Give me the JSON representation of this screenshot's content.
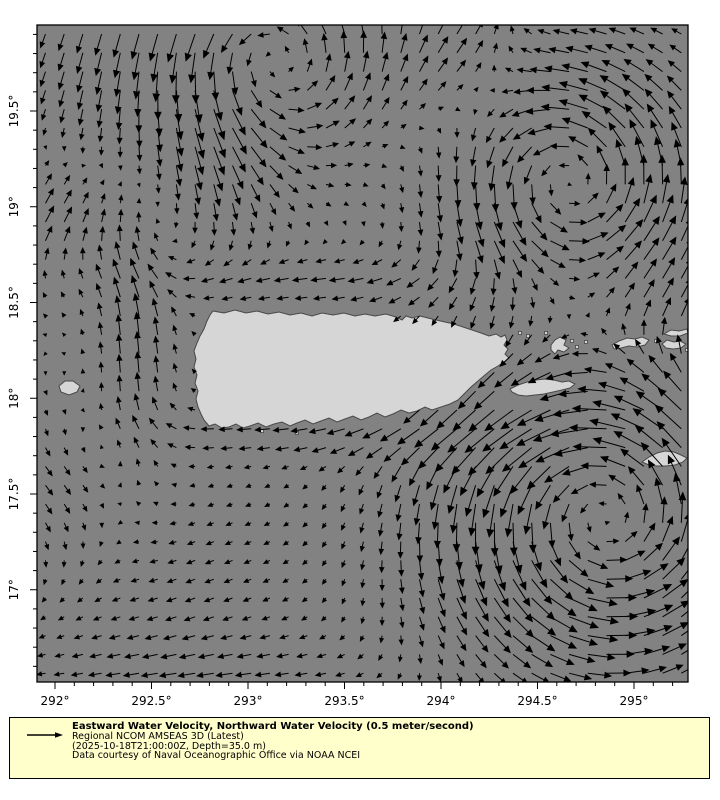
{
  "figure": {
    "width": 720,
    "height": 800,
    "background": "#ffffff"
  },
  "map": {
    "ocean_color": "#828282",
    "land_color": "#d6d6d6",
    "land_edge_color": "#484848",
    "arrow_color": "#000000",
    "frame_color": "#000000",
    "frame": {
      "left": 37,
      "top": 25,
      "right": 688,
      "bottom": 682
    },
    "projection": {
      "lon0": 292,
      "x0": 55,
      "px_per_deg_x": 193,
      "lat0": 19.5,
      "y0": 111,
      "px_per_deg_y": 191.5
    },
    "x_axis": {
      "ticks": [
        {
          "deg": 292.0,
          "label": "292°"
        },
        {
          "deg": 292.5,
          "label": "292.5°"
        },
        {
          "deg": 293.0,
          "label": "293°"
        },
        {
          "deg": 293.5,
          "label": "293.5°"
        },
        {
          "deg": 294.0,
          "label": "294°"
        },
        {
          "deg": 294.5,
          "label": "294.5°"
        },
        {
          "deg": 295.0,
          "label": "295°"
        }
      ],
      "minor_step_deg": 0.1
    },
    "y_axis": {
      "ticks": [
        {
          "deg": 19.5,
          "label": "19.5°"
        },
        {
          "deg": 19.0,
          "label": "19°"
        },
        {
          "deg": 18.5,
          "label": "18.5°"
        },
        {
          "deg": 18.0,
          "label": "18°"
        },
        {
          "deg": 17.5,
          "label": "17.5°"
        },
        {
          "deg": 17.0,
          "label": "17°"
        }
      ],
      "minor_step_deg": 0.1
    }
  },
  "islands": {
    "puerto-rico": [
      [
        213,
        311
      ],
      [
        224,
        313
      ],
      [
        235,
        310
      ],
      [
        246,
        313
      ],
      [
        257,
        311
      ],
      [
        268,
        314
      ],
      [
        279,
        312
      ],
      [
        290,
        315
      ],
      [
        301,
        313
      ],
      [
        312,
        316
      ],
      [
        322,
        313
      ],
      [
        333,
        315
      ],
      [
        344,
        313
      ],
      [
        355,
        316
      ],
      [
        365,
        314
      ],
      [
        375,
        316
      ],
      [
        386,
        314
      ],
      [
        396,
        317
      ],
      [
        402,
        320
      ],
      [
        406,
        316
      ],
      [
        412,
        318
      ],
      [
        420,
        316
      ],
      [
        428,
        318
      ],
      [
        436,
        320
      ],
      [
        445,
        322
      ],
      [
        454,
        324
      ],
      [
        463,
        327
      ],
      [
        472,
        330
      ],
      [
        481,
        333
      ],
      [
        489,
        336
      ],
      [
        496,
        334
      ],
      [
        501,
        337
      ],
      [
        505,
        335
      ],
      [
        507,
        340
      ],
      [
        504,
        345
      ],
      [
        508,
        349
      ],
      [
        505,
        354
      ],
      [
        509,
        358
      ],
      [
        504,
        362
      ],
      [
        498,
        366
      ],
      [
        491,
        370
      ],
      [
        485,
        375
      ],
      [
        478,
        381
      ],
      [
        471,
        387
      ],
      [
        464,
        394
      ],
      [
        458,
        400
      ],
      [
        450,
        404
      ],
      [
        441,
        407
      ],
      [
        432,
        410
      ],
      [
        425,
        407
      ],
      [
        417,
        411
      ],
      [
        409,
        413
      ],
      [
        401,
        410
      ],
      [
        393,
        414
      ],
      [
        385,
        417
      ],
      [
        377,
        413
      ],
      [
        369,
        417
      ],
      [
        361,
        420
      ],
      [
        353,
        416
      ],
      [
        345,
        419
      ],
      [
        337,
        422
      ],
      [
        329,
        418
      ],
      [
        321,
        421
      ],
      [
        313,
        424
      ],
      [
        305,
        420
      ],
      [
        297,
        423
      ],
      [
        290,
        426
      ],
      [
        282,
        422
      ],
      [
        274,
        424
      ],
      [
        266,
        427
      ],
      [
        258,
        423
      ],
      [
        250,
        426
      ],
      [
        243,
        428
      ],
      [
        236,
        424
      ],
      [
        229,
        427
      ],
      [
        222,
        428
      ],
      [
        215,
        424
      ],
      [
        209,
        426
      ],
      [
        204,
        420
      ],
      [
        201,
        414
      ],
      [
        198,
        407
      ],
      [
        196,
        399
      ],
      [
        198,
        391
      ],
      [
        195,
        383
      ],
      [
        197,
        375
      ],
      [
        194,
        367
      ],
      [
        196,
        359
      ],
      [
        194,
        351
      ],
      [
        197,
        343
      ],
      [
        200,
        336
      ],
      [
        204,
        329
      ],
      [
        207,
        321
      ],
      [
        210,
        315
      ]
    ],
    "mona": [
      [
        59,
        386
      ],
      [
        65,
        381
      ],
      [
        73,
        381
      ],
      [
        80,
        386
      ],
      [
        77,
        392
      ],
      [
        69,
        395
      ],
      [
        61,
        392
      ]
    ],
    "vieques": [
      [
        510,
        389
      ],
      [
        518,
        385
      ],
      [
        527,
        382
      ],
      [
        536,
        380
      ],
      [
        545,
        379
      ],
      [
        554,
        380
      ],
      [
        562,
        382
      ],
      [
        569,
        381
      ],
      [
        575,
        384
      ],
      [
        570,
        388
      ],
      [
        562,
        390
      ],
      [
        553,
        392
      ],
      [
        544,
        394
      ],
      [
        535,
        395
      ],
      [
        526,
        396
      ],
      [
        518,
        395
      ],
      [
        512,
        392
      ]
    ],
    "culebra": [
      [
        551,
        345
      ],
      [
        555,
        340
      ],
      [
        560,
        337
      ],
      [
        566,
        340
      ],
      [
        564,
        345
      ],
      [
        569,
        348
      ],
      [
        564,
        352
      ],
      [
        558,
        350
      ],
      [
        555,
        354
      ],
      [
        551,
        350
      ]
    ],
    "st-thomas": [
      [
        612,
        345
      ],
      [
        619,
        341
      ],
      [
        627,
        338
      ],
      [
        635,
        339
      ],
      [
        642,
        337
      ],
      [
        649,
        340
      ],
      [
        645,
        345
      ],
      [
        637,
        347
      ],
      [
        629,
        346
      ],
      [
        621,
        348
      ],
      [
        614,
        349
      ]
    ],
    "st-john": [
      [
        662,
        344
      ],
      [
        667,
        340
      ],
      [
        674,
        342
      ],
      [
        680,
        341
      ],
      [
        686,
        344
      ],
      [
        681,
        348
      ],
      [
        673,
        349
      ],
      [
        666,
        348
      ]
    ],
    "tortola": [
      [
        664,
        334
      ],
      [
        671,
        330
      ],
      [
        679,
        331
      ],
      [
        687,
        329
      ],
      [
        688,
        333
      ],
      [
        680,
        336
      ],
      [
        671,
        336
      ]
    ],
    "st-croix": [
      [
        642,
        462
      ],
      [
        649,
        457
      ],
      [
        657,
        453
      ],
      [
        665,
        451
      ],
      [
        674,
        452
      ],
      [
        681,
        455
      ],
      [
        687,
        458
      ],
      [
        683,
        462
      ],
      [
        675,
        465
      ],
      [
        666,
        466
      ],
      [
        657,
        466
      ],
      [
        649,
        465
      ]
    ],
    "islets": [
      [
        520,
        333
      ],
      [
        528,
        336
      ],
      [
        546,
        333
      ],
      [
        572,
        341
      ],
      [
        577,
        347
      ],
      [
        586,
        342
      ],
      [
        656,
        341
      ],
      [
        297,
        433
      ],
      [
        262,
        431
      ],
      [
        687,
        350
      ]
    ]
  },
  "quiver": {
    "grid": {
      "x0": 45.5,
      "dx": 18.7,
      "cols": 35,
      "y0": 34,
      "dy": 18.8,
      "rows": 35
    },
    "scale_px_per_mps": 60,
    "speed_cap_mps": 0.62,
    "features": [
      {
        "type": "vortex",
        "lon": 294.67,
        "lat": 19.15,
        "radius": 0.42,
        "strength": 0.48
      },
      {
        "type": "vortex",
        "lon": 294.85,
        "lat": 17.4,
        "radius": 0.55,
        "strength": 0.55
      },
      {
        "type": "vortex",
        "lon": 293.1,
        "lat": 19.8,
        "radius": 0.4,
        "strength": 0.35
      },
      {
        "type": "band",
        "lon": 292.42,
        "sigma_lon": 0.16,
        "lat": 18.35,
        "sigma_lat": 0.6,
        "u": 0,
        "v": 0.38
      },
      {
        "type": "band",
        "lon": 293.6,
        "sigma_lon": 1.0,
        "lat": 18.62,
        "sigma_lat": 0.12,
        "u": -0.22,
        "v": 0
      },
      {
        "type": "band",
        "lon": 293.6,
        "sigma_lon": 0.9,
        "lat": 17.82,
        "sigma_lat": 0.1,
        "u": -0.22,
        "v": 0
      },
      {
        "type": "blob",
        "lon": 292.15,
        "lat": 19.75,
        "sigma": 0.35,
        "u": -0.05,
        "v": -0.25
      },
      {
        "type": "blob",
        "lon": 291.95,
        "lat": 18.95,
        "sigma": 0.25,
        "u": 0.18,
        "v": 0.28
      },
      {
        "type": "blob",
        "lon": 295.25,
        "lat": 18.4,
        "sigma": 0.3,
        "u": 0.3,
        "v": 0.12
      },
      {
        "type": "blob",
        "lon": 294.15,
        "lat": 19.75,
        "sigma": 0.3,
        "u": 0.35,
        "v": 0.3
      },
      {
        "type": "blob",
        "lon": 291.95,
        "lat": 17.55,
        "sigma": 0.35,
        "u": 0.18,
        "v": -0.15
      },
      {
        "type": "blob",
        "lon": 292.6,
        "lat": 16.9,
        "sigma": 0.5,
        "u": -0.12,
        "v": -0.06
      },
      {
        "type": "band",
        "lon": 292.9,
        "sigma_lon": 0.7,
        "lat": 16.55,
        "sigma_lat": 0.15,
        "u": -0.15,
        "v": 0
      },
      {
        "type": "blob",
        "lon": 292.85,
        "lat": 19.25,
        "sigma": 0.35,
        "u": -0.05,
        "v": -0.3
      },
      {
        "type": "background",
        "u": -0.04,
        "v": 0.0
      }
    ]
  },
  "legend": {
    "background": "#ffffcc",
    "border_color": "#000000",
    "reference_speed_mps": 0.5,
    "title": "Eastward Water Velocity, Northward Water Velocity (0.5 meter/second)",
    "model_line": "Regional NCOM AMSEAS 3D (Latest)",
    "time_line": "(2025-10-18T21:00:00Z, Depth=35.0 m)",
    "credit_line": "Data courtesy of Naval Oceanographic Office via NOAA NCEI"
  },
  "chart_data": {
    "type": "quiver",
    "title": "Eastward Water Velocity, Northward Water Velocity (0.5 meter/second)",
    "subtitle": "Regional NCOM AMSEAS 3D (Latest)",
    "timestamp": "2025-10-18T21:00:00Z",
    "depth": "35.0 m",
    "lon_range_deg_e": [
      291.91,
      295.28
    ],
    "lat_range_deg_n": [
      16.52,
      19.95
    ],
    "x_tick_labels": [
      "292°",
      "292.5°",
      "293°",
      "293.5°",
      "294°",
      "294.5°",
      "295°"
    ],
    "y_tick_labels": [
      "19.5°",
      "19°",
      "18.5°",
      "18°",
      "17.5°",
      "17°"
    ],
    "reference_vector_mps": 0.5,
    "grid_spacing_deg": 0.1,
    "notable_features": [
      "cyclonic (counterclockwise) eddy northeast of Puerto Rico near 294.7E 19.15N",
      "cyclonic eddy south of Vieques near 294.85E 17.4N",
      "northward jet through Mona Passage near 292.4E",
      "westward flow along north and south coasts of Puerto Rico"
    ],
    "legend_position": "bottom",
    "grid": "off"
  }
}
